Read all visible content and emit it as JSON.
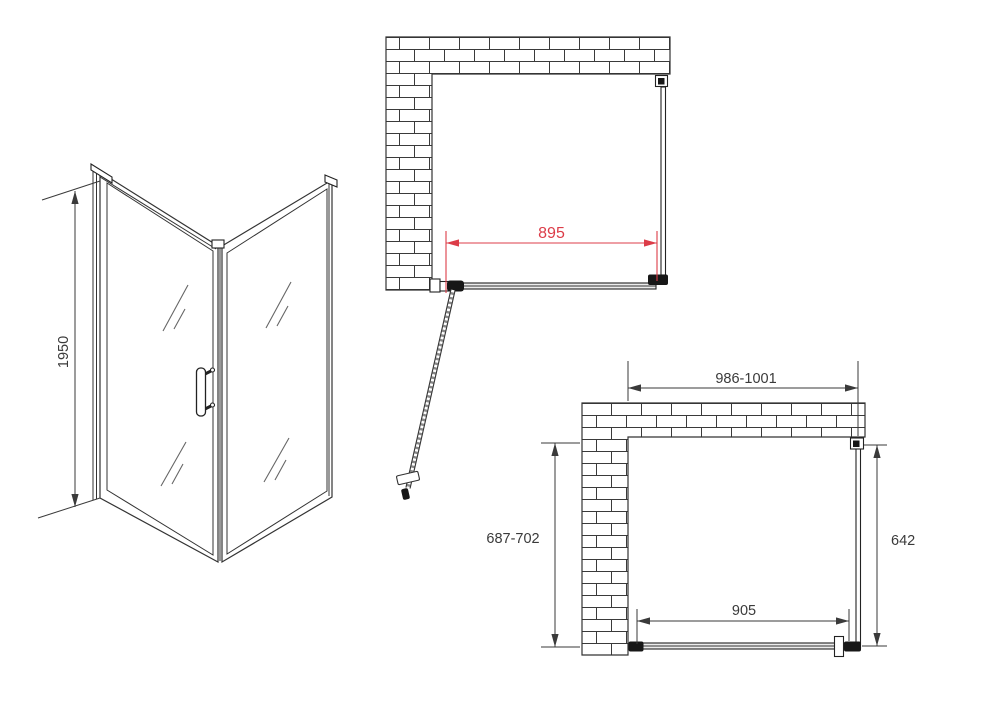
{
  "colors": {
    "dim_accent_red": "#dc3c48",
    "line": "#333333"
  },
  "views": {
    "side_3d": {
      "height": "1950"
    },
    "plan_top": {
      "door_glass_width": "895"
    },
    "plan_bottom": {
      "overall_width": "986-1001",
      "wall_side_depth": "687-702",
      "side_panel_depth": "642",
      "door_opening_width": "905"
    }
  }
}
